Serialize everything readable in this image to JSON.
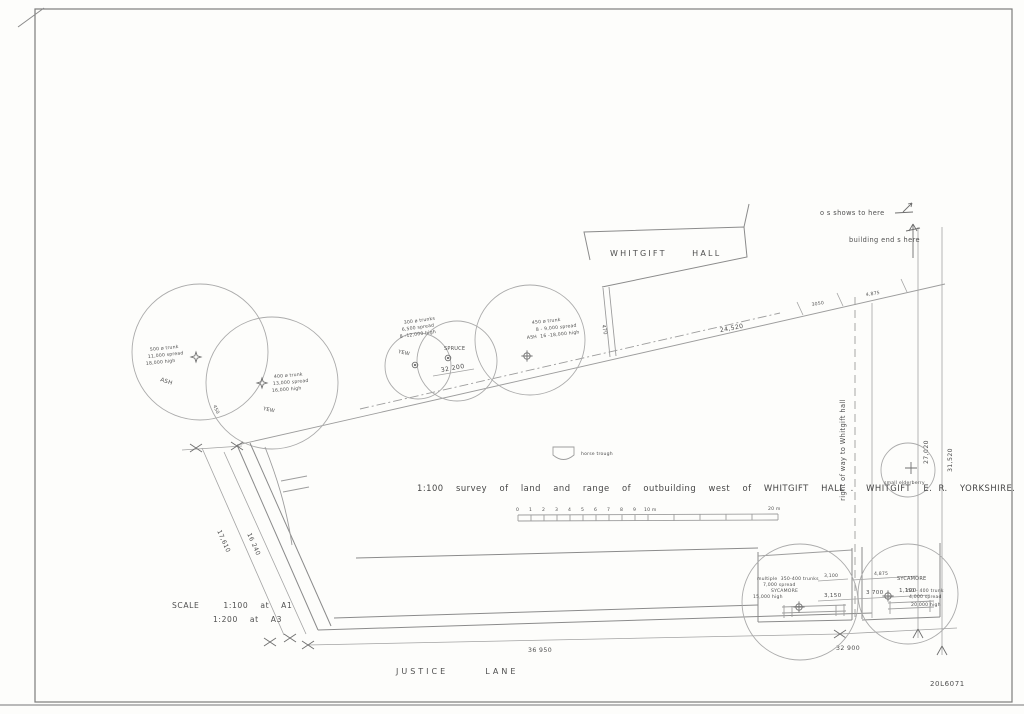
{
  "labels": {
    "hall": "WHITGIFT  HALL",
    "road": "JUSTICE  LANE",
    "title": "1:100  survey  of  land  and  range  of  outbuilding  west  of  WHITGIFT  HALL .  WHITGIFT  E. R.  YORKSHIRE.",
    "scale_line1": "SCALE    1:100  at  A1",
    "scale_line2": "1:200  at  A3",
    "drawing_number": "20L6071",
    "horse_trough": "horse trough"
  },
  "notes": {
    "os_shows": "o s shows to here",
    "building_ends": "building end s here",
    "right_of_way": "right of way to Whitgift hall"
  },
  "dims": {
    "boundary_top": "24,520",
    "inner_span": "32 200",
    "hall_gap": "470",
    "top_small_a": "3050",
    "top_small_b": "4,875",
    "right_inner": "27,020",
    "right_outer": "31,520",
    "left_outer": "17,610",
    "left_inner": "16 240",
    "bottom_main": "36 950",
    "bottom_right": "32 900",
    "ob_top_a": "3,100",
    "ob_top_b": "4,875",
    "ob_a": "3,150",
    "ob_b": "3 700",
    "ob_c": "1,100",
    "corner_small": "450"
  },
  "trees": {
    "ash_large": {
      "name": "ASH",
      "spec": [
        "500 ø trunk",
        "11,000 spread",
        "18,000 high"
      ]
    },
    "yew_large": {
      "name": "YEW",
      "spec": [
        "400 ø trunk",
        "13,000 spread",
        "16,000 high"
      ]
    },
    "yew_small": {
      "name": "YEW"
    },
    "spruce": {
      "name": "SPRUCE",
      "spec": [
        "300 ø trunks",
        "6,500 spread",
        "8 -12,000 high"
      ]
    },
    "ash_mid": {
      "spec": [
        "450 ø trunk",
        "8 - 9,000 spread",
        "ASH  16 -18,000 high"
      ]
    },
    "sycamore_group": {
      "spec": [
        "multiple  350-400 trunks",
        "7,000 spread",
        "SYCAMORE",
        "15,000 high"
      ]
    },
    "sycamore_right": {
      "name": "SYCAMORE",
      "spec": [
        "350 - 400 trunk",
        "4,000 spread",
        "20,000 high"
      ]
    },
    "elderberry": {
      "name": "small elderberry"
    }
  },
  "scalebar": {
    "ticks": [
      "0",
      "1",
      "2",
      "3",
      "4",
      "5",
      "6",
      "7",
      "8",
      "9",
      "10 m"
    ],
    "end": "20 m"
  }
}
